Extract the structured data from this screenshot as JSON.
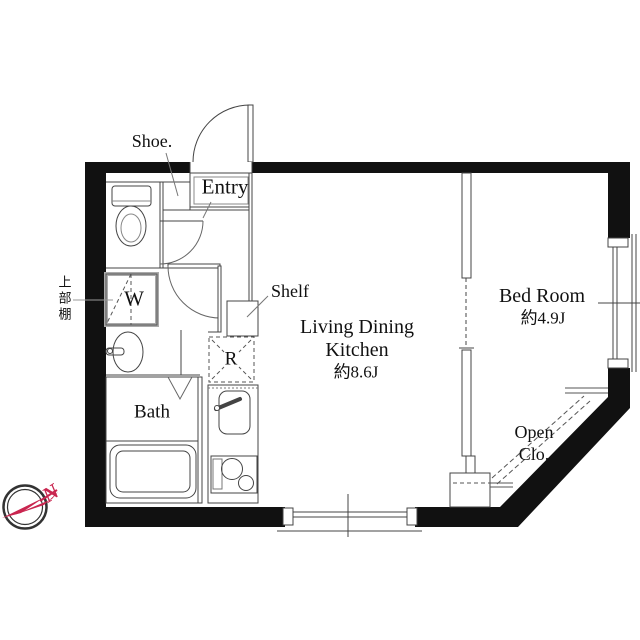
{
  "floorplan": {
    "labels": {
      "shoe": "Shoe.",
      "entry": "Entry",
      "shelf": "Shelf",
      "ldk_line1": "Living Dining",
      "ldk_line2": "Kitchen",
      "ldk_size": "約8.6J",
      "bedroom": "Bed Room",
      "bedroom_size": "約4.9J",
      "bath": "Bath",
      "open_closet_line1": "Open",
      "open_closet_line2": "Clo.",
      "upper_shelf": "上部棚",
      "washer": "W",
      "refrigerator": "R",
      "compass_direction": "N"
    },
    "colors": {
      "wall": "#111111",
      "line": "#444444",
      "compass_red": "#c9254f"
    }
  }
}
